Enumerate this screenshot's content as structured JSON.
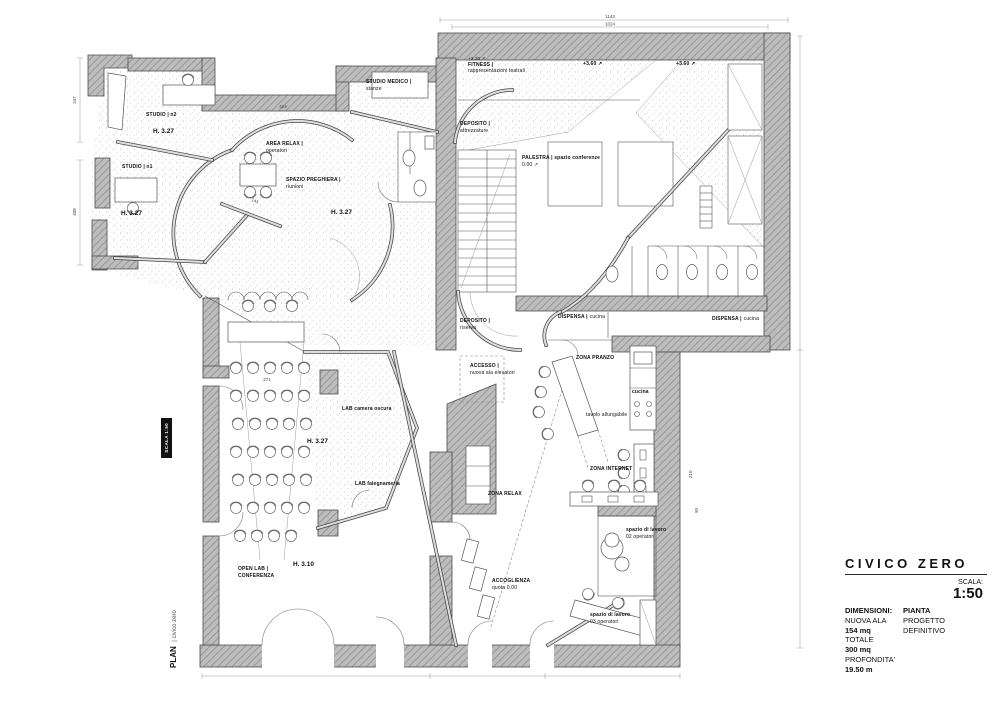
{
  "labels": {
    "studio_n2": {
      "label": "STUDIO | n2"
    },
    "h327_a": {
      "label": "H. 3.27"
    },
    "studio_n1": {
      "label": "STUDIO | n1"
    },
    "h327_b": {
      "label": "H. 3.27"
    },
    "area_relax": {
      "label": "AREA RELAX |",
      "sub": "operatori"
    },
    "spazio_preghiera": {
      "label": "SPAZIO PREGHIERA |",
      "sub": "riunioni"
    },
    "h327_c": {
      "label": "H. 3.27"
    },
    "studio_medico": {
      "label": "STUDIO MEDICO |",
      "sub": "stanze"
    },
    "fitness": {
      "quota": "+3.20 ↗",
      "label": "FITNESS |",
      "sub": "rappresentazioni teatrali"
    },
    "quota_360_a": {
      "label": "+3.60 ↗"
    },
    "quota_360_b": {
      "label": "+3.60 ↗"
    },
    "deposito_attrezzature": {
      "label": "DEPOSITO |",
      "sub": "attrezzature"
    },
    "palestra": {
      "label": "PALESTRA | spazio conferenze",
      "quota": "0.00 ↗"
    },
    "deposito_riserva": {
      "label": "DEPOSITO |",
      "sub": "riserva"
    },
    "accesso": {
      "label": "ACCESSO |",
      "sub": "nuova ala elevatori"
    },
    "dispensa_a": {
      "label": "DISPENSA |",
      "sub": "cucina"
    },
    "dispensa_b": {
      "label": "DISPENSA |",
      "sub": "cucina"
    },
    "zona_pranzo": {
      "label": "ZONA PRANZO"
    },
    "tavolo": {
      "label": "tavolo allungabile"
    },
    "cucina": {
      "label": "cucina"
    },
    "lab_camera_oscura": {
      "label": "LAB camera oscura"
    },
    "h327_d": {
      "label": "H. 3.27"
    },
    "lab_falegnameria": {
      "label": "LAB falegnameria"
    },
    "zona_internet": {
      "label": "ZONA INTERNET"
    },
    "zona_relax": {
      "label": "ZONA RELAX"
    },
    "spazio_lavoro_02": {
      "label": "spazio di lavoro",
      "sub": "02 operatori"
    },
    "accoglienza": {
      "label": "ACCOGLIENZA",
      "sub": "quota 0.00"
    },
    "open_lab": {
      "label": "OPEN LAB |",
      "sub": "CONFERENZA"
    },
    "h310": {
      "label": "H. 3.10"
    },
    "spazio_lavoro_03": {
      "label": "spazio di lavoro",
      "sub": "03 operatori"
    }
  },
  "dimensions": {
    "top_outer": "1143",
    "top_inner": "1024",
    "left_upper": "247",
    "left_lower": "408",
    "relax_width": "424",
    "bench": "141",
    "seats": "271",
    "d210": "210",
    "d90": "90"
  },
  "side": {
    "scala_badge": "SCALA 1:50",
    "plan": "PLAN",
    "plan_sub": "| civico zero"
  },
  "title_block": {
    "title": "CIVICO ZERO",
    "scala_label": "SCALA:",
    "scala_value": "1:50",
    "col1": [
      "DIMENSIONI:",
      "NUOVA ALA",
      "154 mq",
      "TOTALE",
      "300 mq",
      "PROFONDITA'",
      "19.50 m"
    ],
    "col2": [
      "PIANTA",
      "PROGETTO",
      "DEFINITIVO"
    ]
  },
  "colors": {
    "wall_fill": "#bdbdbd",
    "hatch_line": "#8d8d8d",
    "ink": "#1a1a1a"
  }
}
